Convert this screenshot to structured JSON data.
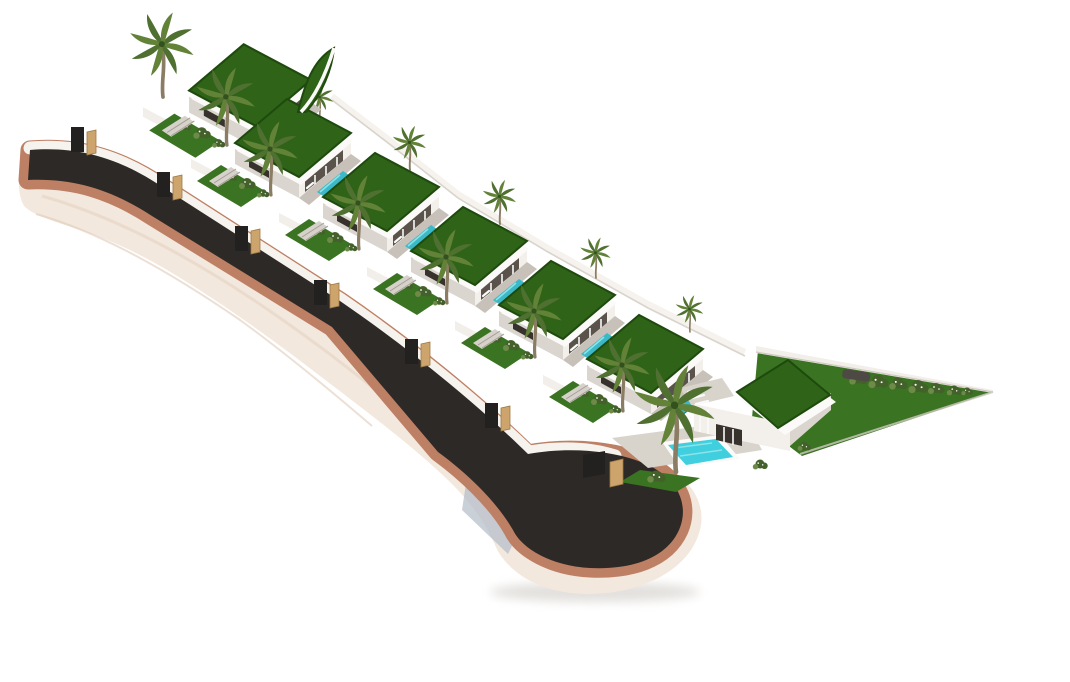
{
  "image": {
    "type": "architectural-3d-render",
    "width": 1070,
    "height": 682,
    "description": "Isometric aerial 3D rendering of a residential development: seven modern white villas with green planted flat roofs, covered terraces, turquoise pools and palm trees, stepped along a dark asphalt road with terracotta curbs that ends in a teardrop cul-de-sac on a white background."
  },
  "colors": {
    "background": "#ffffff",
    "terrain": "#f3e8dd",
    "terrain_wave1": "#e7d8ca",
    "terrain_wave2": "#dfccbb",
    "curb": "#bd8064",
    "asphalt": "#2d2926",
    "street_wall": "#f6f3ee",
    "wall_face": "#f2eee9",
    "wall_edge": "#cfc9c1",
    "face_light": "#f3f0ec",
    "face_shade": "#dad5cf",
    "fascia": "#fbfaf8",
    "porch": "#5a534c",
    "glass": "#38322d",
    "roof_grass": "#2e6318",
    "roof_grass_dark": "#1f4a0e",
    "lawn": "#3a7322",
    "deck": "#c7c1b9",
    "deck_light": "#d8d3cb",
    "stairs": "#d6d1ca",
    "stair_line": "#a49d94",
    "pool": "#3bb9c9",
    "pool_light": "#90e4e8",
    "pool_bright": "#3fcfdf",
    "pool_edge": "#1f7f8c",
    "pillar": "#cda46c",
    "pillar_dark": "#9d7a47",
    "gate": "#232120",
    "palm_trunk": "#8b7d64",
    "palm_leaf": "#4f7030",
    "palm_leaf_light": "#628238",
    "palm_core": "#33511f",
    "bush": "#44602b",
    "bush_light": "#6e8a49",
    "flower": "#ffffff",
    "shadow_blue": "#b7c0cb",
    "ground_shadow": "#dbd8d4",
    "car": "#4e4944"
  },
  "scene": {
    "villa_count": 7,
    "pool_count": 7,
    "standard_villas": [
      [
        250,
        80,
        1.05
      ],
      [
        293,
        133,
        1
      ],
      [
        381,
        187,
        1
      ],
      [
        469,
        241,
        1
      ],
      [
        557,
        295,
        1
      ],
      [
        645,
        349,
        1
      ]
    ],
    "last_villa_position": [
      783,
      395
    ],
    "entrance_gates": [
      [
        86,
        152
      ],
      [
        172,
        197
      ],
      [
        250,
        251
      ],
      [
        329,
        305
      ],
      [
        420,
        364
      ],
      [
        500,
        428
      ]
    ],
    "background_palms": [
      [
        320,
        120,
        0.5
      ],
      [
        410,
        170,
        0.6
      ],
      [
        500,
        224,
        0.6
      ],
      [
        596,
        278,
        0.55
      ],
      [
        690,
        332,
        0.5
      ]
    ],
    "foreground_palms": [
      [
        163,
        97,
        1.15
      ]
    ],
    "hedge_bushes": [
      [
        858,
        378,
        1.1
      ],
      [
        878,
        381,
        1.2
      ],
      [
        898,
        383,
        1.1
      ],
      [
        918,
        386,
        1.2
      ],
      [
        936,
        388,
        1.0
      ],
      [
        954,
        390,
        0.9
      ],
      [
        967,
        391,
        0.7
      ]
    ]
  }
}
